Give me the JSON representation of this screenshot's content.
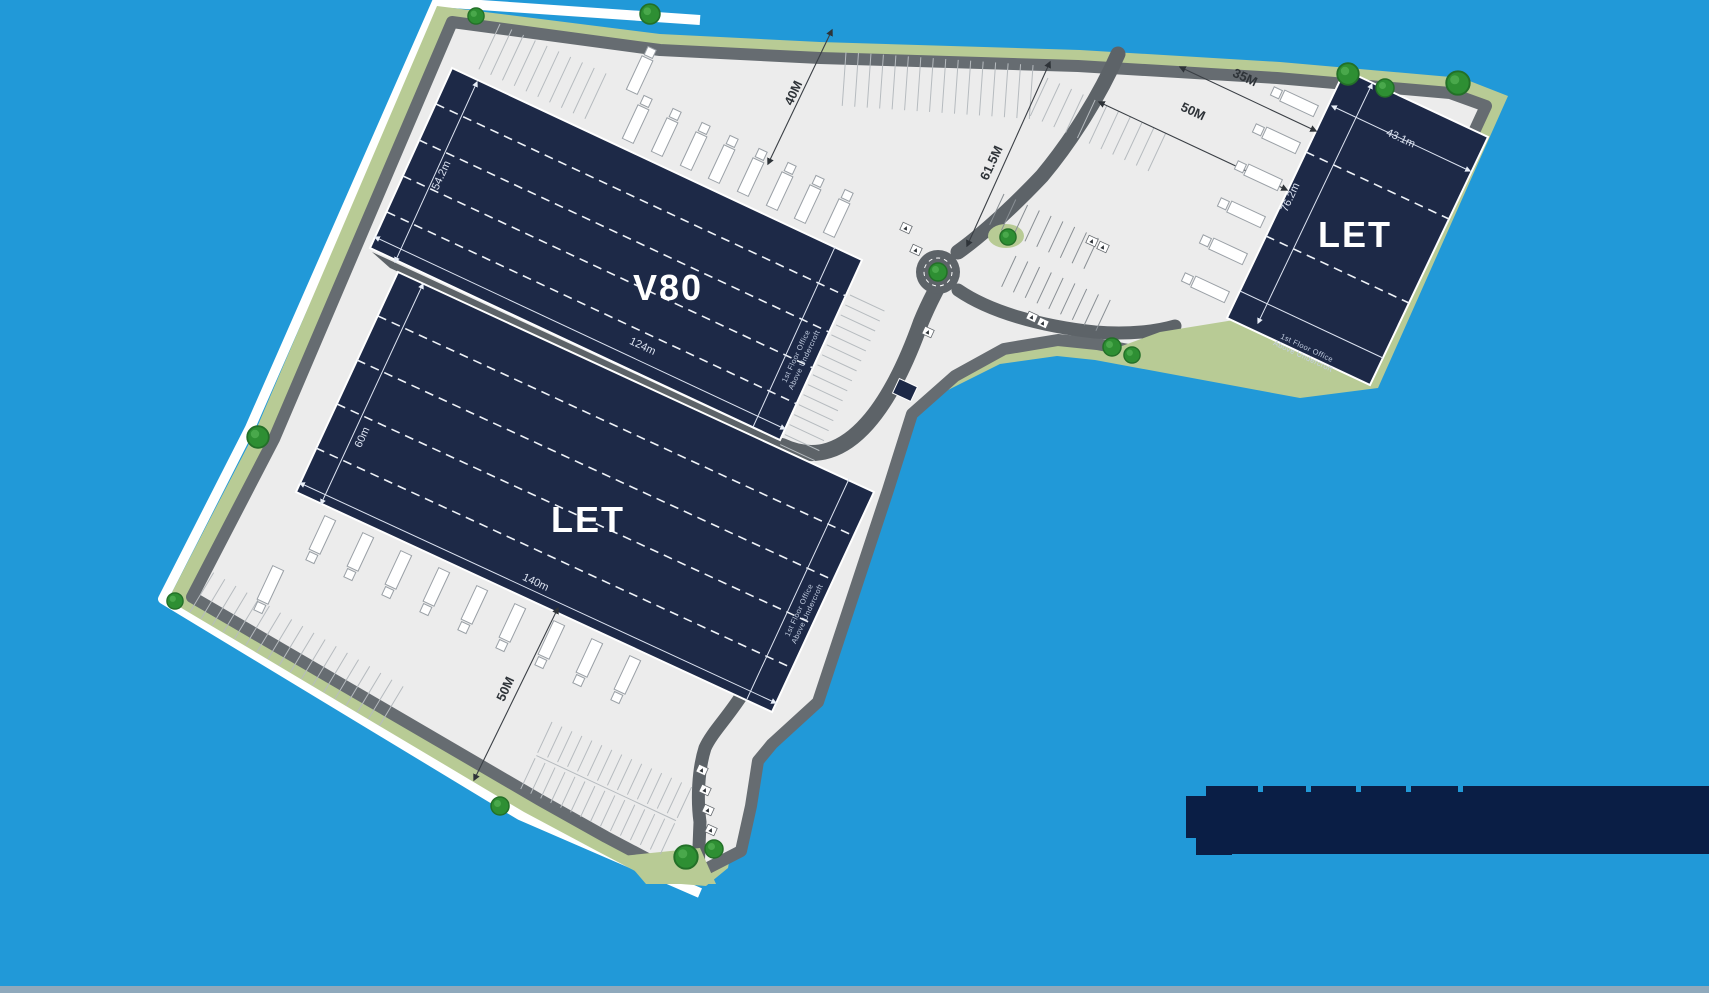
{
  "colors": {
    "background": "#2199d8",
    "building": "#1d2947",
    "building_outline": "#ffffff",
    "landscape": "#b8cb95",
    "tree": "#2e8f33",
    "hardstanding": "#ececec",
    "road": "#5d6368",
    "logo_bar": "#0a1e45",
    "dimension_text": "#2e3338"
  },
  "buildings": [
    {
      "id": "v80",
      "label": "V80",
      "depth": "54.2m",
      "length": "124m",
      "office_line1": "1st Floor Office",
      "office_line2": "Above Undercroft"
    },
    {
      "id": "unit-south",
      "label": "LET",
      "depth": "60m",
      "length": "140m",
      "office_line1": "1st Floor Office",
      "office_line2": "Above Undercroft"
    },
    {
      "id": "unit-east",
      "label": "LET",
      "depth": "76.2m",
      "length": "43.1m",
      "office_line1": "1st Floor Office",
      "office_line2": "Above Undercroft"
    }
  ],
  "yard_dimensions": {
    "north_yard": "40M",
    "east_yard": "61.5M",
    "northeast_road": "50M",
    "northeast_top": "35M",
    "southwest_yard": "50M"
  }
}
